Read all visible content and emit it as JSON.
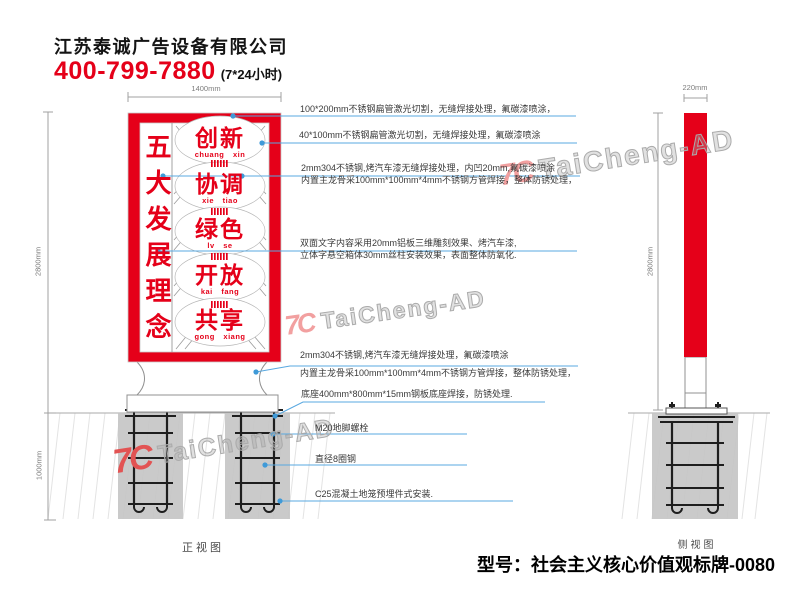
{
  "header": {
    "company": "江苏泰诚广告设备有限公司",
    "phone": "400-799-7880",
    "hours": "(7*24小时)"
  },
  "dimensions": {
    "front_width": "1400mm",
    "front_height": "2800mm",
    "foundation_depth": "1000mm",
    "side_width": "220mm",
    "side_height": "2800mm"
  },
  "sign": {
    "slogan": "五大发展理念",
    "words": [
      {
        "cn": "创新",
        "py": "chuang xin"
      },
      {
        "cn": "协调",
        "py": "xie tiao"
      },
      {
        "cn": "绿色",
        "py": "lv se"
      },
      {
        "cn": "开放",
        "py": "kai fang"
      },
      {
        "cn": "共享",
        "py": "gong xiang"
      }
    ]
  },
  "annotations": [
    {
      "line1": "100*200mm不锈钢扁管激光切割，无缝焊接处理，氟碳漆喷涂，"
    },
    {
      "line1": "40*100mm不锈钢扁管激光切割，无缝焊接处理，氟碳漆喷涂"
    },
    {
      "line1": "2mm304不锈钢,烤汽车漆无缝焊接处理，内凹20mm,氟碳漆喷涂",
      "line2": "内置主龙骨采100mm*100mm*4mm不锈钢方管焊接，整体防锈处理，"
    },
    {
      "line1": "双面文字内容采用20mm铝板三维雕刻效果、烤汽车漆,",
      "line2": "立体字悬空箱体30mm丝柱安装效果，表面整体防氧化."
    },
    {
      "line1": "2mm304不锈钢,烤汽车漆无缝焊接处理，氟碳漆喷涂",
      "line2": "内置主龙骨采100mm*100mm*4mm不锈钢方管焊接，整体防锈处理，"
    },
    {
      "line1": "底座400mm*800mm*15mm钢板底座焊接，防锈处理."
    },
    {
      "line1": "M20地脚螺栓"
    },
    {
      "line1": "直径8圈钢"
    },
    {
      "line1": "C25混凝土地笼预埋件式安装."
    }
  ],
  "views": {
    "front": "正视图",
    "side": "侧视图"
  },
  "watermark": {
    "logo": "7C",
    "text": "TaiCheng-AD"
  },
  "footer": {
    "model": "型号：社会主义核心价值观标牌-0080"
  },
  "colors": {
    "accent_red": "#e50019",
    "leader_blue": "#58a8e0",
    "foundation_gray": "#c6c6c6"
  }
}
